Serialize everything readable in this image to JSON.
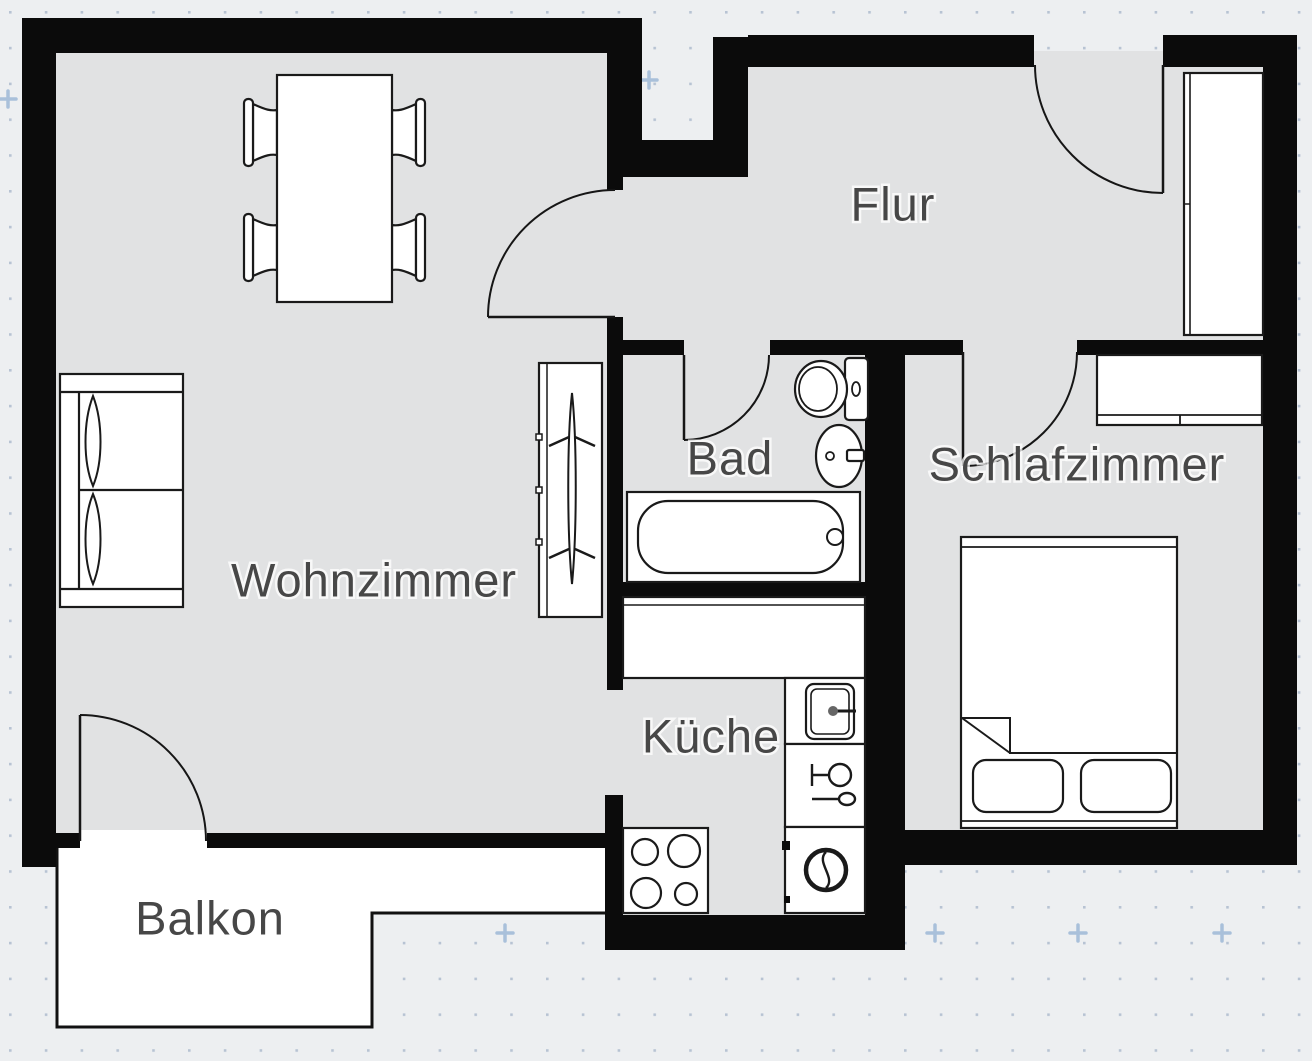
{
  "title": "Apartment floor plan",
  "colors": {
    "wall": "#0b0b0b",
    "floor": "#e1e2e3",
    "background": "#edeff1",
    "furniture_fill": "#ffffff",
    "outline": "#1a1a1a",
    "label": "#474747",
    "grid_dot": "#b7c3d3",
    "grid_plus": "#a9c0da"
  },
  "rooms": [
    {
      "name": "wohnzimmer",
      "label": "Wohnzimmer"
    },
    {
      "name": "flur",
      "label": "Flur"
    },
    {
      "name": "bad",
      "label": "Bad"
    },
    {
      "name": "schlafzimmer",
      "label": "Schlafzimmer"
    },
    {
      "name": "kueche",
      "label": "Küche"
    },
    {
      "name": "balkon",
      "label": "Balkon"
    }
  ],
  "furniture": [
    "dining-table",
    "chair",
    "chair",
    "chair",
    "chair",
    "sofa",
    "wardrobe-with-rail",
    "toilet",
    "washbasin",
    "bathtub",
    "kitchen-counter",
    "kitchen-sink",
    "dishwasher",
    "washing-machine",
    "stove",
    "bed",
    "pillow",
    "pillow",
    "sideboard",
    "hall-wardrobe"
  ],
  "doors": [
    "entrance-door",
    "living-room-door",
    "bathroom-door",
    "bedroom-door",
    "balcony-door"
  ]
}
